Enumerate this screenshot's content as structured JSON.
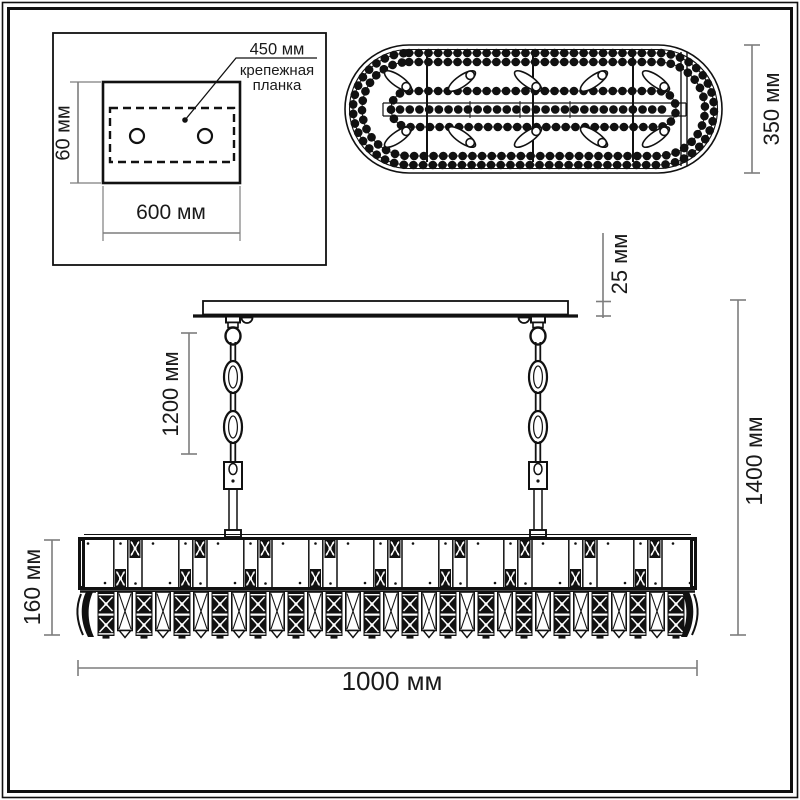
{
  "colors": {
    "ink": "#111111",
    "dim-line": "#7d7d7d",
    "paper": "#ffffff",
    "label": "#1a1a1a"
  },
  "mount_detail": {
    "bracket_length": "450 мм",
    "bracket_name_line1": "крепежная",
    "bracket_name_line2": "планка",
    "plate_height": "60 мм",
    "plate_width": "600 мм"
  },
  "top_view": {
    "fixture_depth": "350 мм"
  },
  "front_view": {
    "canopy_thickness": "25 мм",
    "chain_length": "1200 мм",
    "total_height": "1400 мм",
    "body_height": "160 мм",
    "body_width": "1000 мм"
  }
}
